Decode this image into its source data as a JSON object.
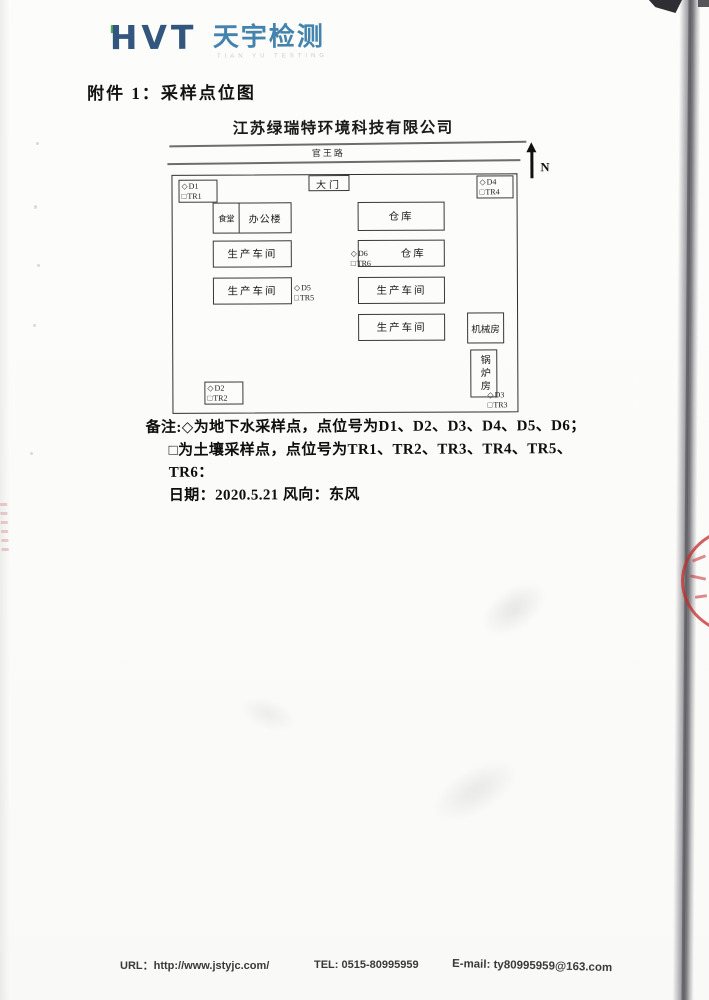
{
  "logo": {
    "monogram": "HVT",
    "brand": "天宇检测",
    "subtext": "TIAN YU TESTING",
    "monogram_color": "#33567f",
    "brand_color": "#4383ad",
    "accent_green": "#4caf50"
  },
  "title": "附件 1：采样点位图",
  "diagram": {
    "company_name": "江苏绿瑞特环境科技有限公司",
    "road_name": "官王路",
    "gate_label": "大门",
    "north_label": "N",
    "symbols": {
      "well": "◇",
      "soil": "□"
    },
    "sample_points": [
      {
        "well": "D1",
        "soil": "TR1"
      },
      {
        "well": "D2",
        "soil": "TR2"
      },
      {
        "well": "D3",
        "soil": "TR3"
      },
      {
        "well": "D4",
        "soil": "TR4"
      },
      {
        "well": "D5",
        "soil": "TR5"
      },
      {
        "well": "D6",
        "soil": "TR6"
      }
    ],
    "buildings": [
      {
        "label": "食堂"
      },
      {
        "label": "办公楼"
      },
      {
        "label": "仓库"
      },
      {
        "label": "生产车间"
      },
      {
        "label": "仓库"
      },
      {
        "label": "生产车间"
      },
      {
        "label": "生产车间"
      },
      {
        "label": "生产车间"
      },
      {
        "label": "机械房"
      },
      {
        "label": "锅炉房"
      }
    ]
  },
  "notes": {
    "line1": "备注:◇为地下水采样点，点位号为D1、D2、D3、D4、D5、D6；",
    "line2": "□为土壤采样点，点位号为TR1、TR2、TR3、TR4、TR5、TR6：",
    "line3": "日期：2020.5.21  风向：东风"
  },
  "footer": {
    "url": "URL：http://www.jstyjc.com/",
    "tel": "TEL: 0515-80995959",
    "email": "E-mail: ty80995959@163.com"
  },
  "stamp_color": "#c62c2c"
}
